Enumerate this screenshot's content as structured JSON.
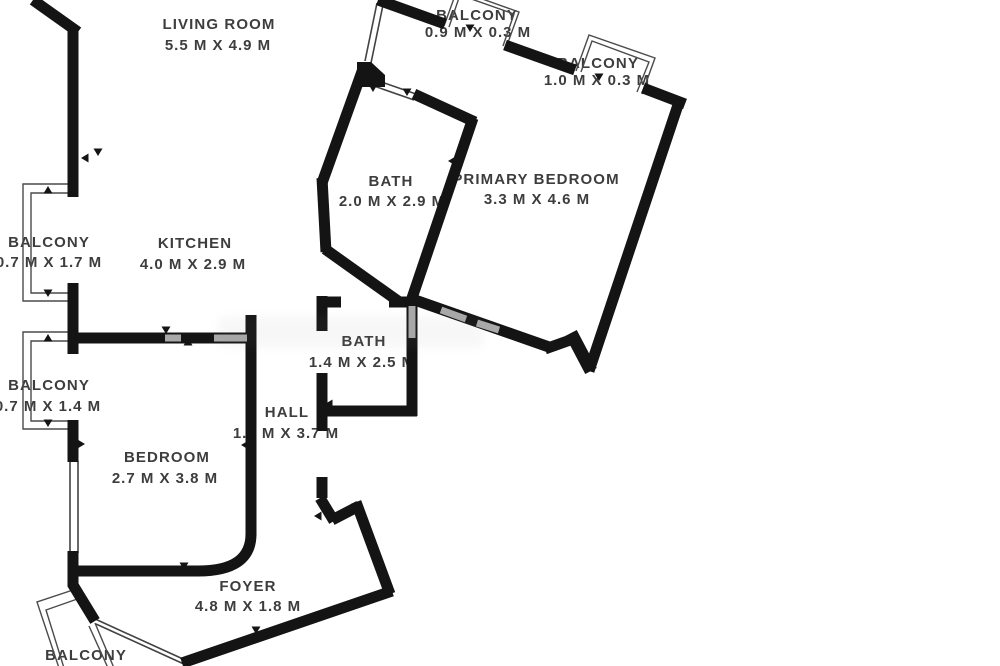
{
  "floorplan": {
    "background_color": "#ffffff",
    "wall_color": "#141414",
    "window_line_color": "#424242",
    "window_gray_color": "#a9a9a9",
    "text_color": "#3d3d3d",
    "rooms": [
      {
        "label": "LIVING ROOM",
        "dims": "5.5 M X 4.9 M",
        "lx": 219,
        "ly": 29,
        "dx": 218,
        "dy": 50
      },
      {
        "label": "BALCONY",
        "dims": "0.9 M X 0.3 M",
        "lx": 477,
        "ly": 20,
        "dx": 478,
        "dy": 37
      },
      {
        "label": "BALCONY",
        "dims": "1.0 M X 0.3 M",
        "lx": 598,
        "ly": 68,
        "dx": 597,
        "dy": 85
      },
      {
        "label": "BATH",
        "dims": "2.0 M X 2.9 M",
        "lx": 391,
        "ly": 186,
        "dx": 392,
        "dy": 206
      },
      {
        "label": "PRIMARY BEDROOM",
        "dims": "3.3 M X 4.6 M",
        "lx": 536,
        "ly": 184,
        "dx": 537,
        "dy": 204
      },
      {
        "label": "BALCONY",
        "dims": "0.7 M X 1.7 M",
        "lx": 49,
        "ly": 247,
        "dx": 49,
        "dy": 267
      },
      {
        "label": "KITCHEN",
        "dims": "4.0 M X 2.9 M",
        "lx": 195,
        "ly": 248,
        "dx": 193,
        "dy": 269
      },
      {
        "label": "BALCONY",
        "dims": "0.7 M X 1.4 M",
        "lx": 49,
        "ly": 390,
        "dx": 48,
        "dy": 411
      },
      {
        "label": "BATH",
        "dims": "1.4 M X 2.5 M",
        "lx": 364,
        "ly": 346,
        "dx": 362,
        "dy": 367
      },
      {
        "label": "HALL",
        "dims": "1.1 M X 3.7 M",
        "lx": 287,
        "ly": 417,
        "dx": 286,
        "dy": 438
      },
      {
        "label": "BEDROOM",
        "dims": "2.7 M X 3.8 M",
        "lx": 167,
        "ly": 462,
        "dx": 165,
        "dy": 483
      },
      {
        "label": "FOYER",
        "dims": "4.8 M X 1.8 M",
        "lx": 248,
        "ly": 591,
        "dx": 248,
        "dy": 611
      },
      {
        "label": "BALCONY",
        "dims": "",
        "lx": 86,
        "ly": 660,
        "dx": 86,
        "dy": 681
      }
    ]
  }
}
